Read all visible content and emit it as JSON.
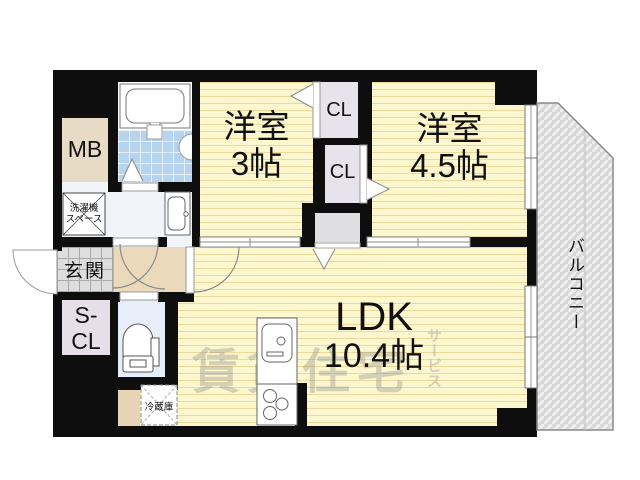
{
  "floorplan": {
    "rooms": {
      "bedroom1": {
        "name": "洋室",
        "size": "3帖"
      },
      "bedroom2": {
        "name": "洋室",
        "size": "4.5帖"
      },
      "ldk": {
        "name": "LDK",
        "size": "10.4帖"
      },
      "balcony": {
        "name": "バルコニー"
      },
      "entrance": {
        "name": "玄関"
      },
      "meter_box": {
        "label": "MB"
      },
      "shoe_closet": {
        "line1": "S-",
        "line2": "CL"
      },
      "closet1": {
        "label": "CL"
      },
      "closet2": {
        "label": "CL"
      },
      "washer_space": {
        "line1": "洗濯機",
        "line2": "スペース"
      },
      "refrigerator": {
        "label": "冷蔵庫"
      }
    },
    "watermark": {
      "main": "賃貸住宅",
      "sub": "サービス"
    },
    "colors": {
      "wall": "#0e0e0e",
      "tatami_fill": "#fdf7cf",
      "balcony_fill": "#d8d8d8",
      "bath_tile": "#b7d4ef",
      "hall_fill": "#ead9bb",
      "mb_fill": "#e7dbc5",
      "closet_fill": "#e7e3ec",
      "toilet_fill": "#e7eef8"
    }
  }
}
